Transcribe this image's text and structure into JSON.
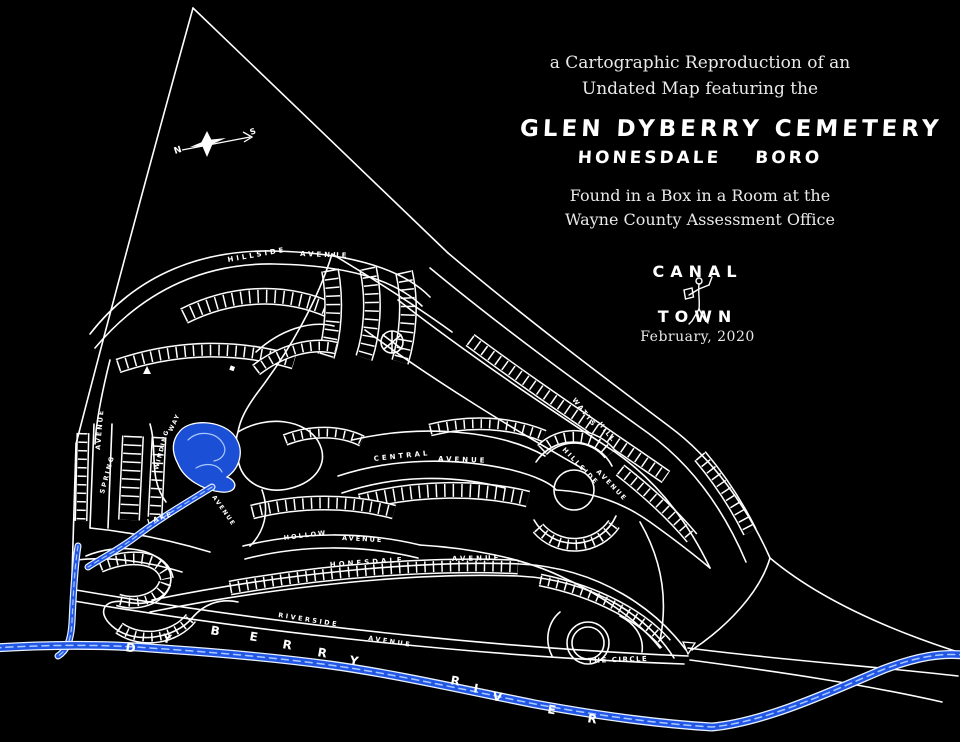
{
  "title_block": {
    "subtitle1": "a Cartographic Reproduction of an",
    "subtitle2": "Undated Map featuring the",
    "heading1": "GLEN DYBERRY CEMETERY",
    "heading2_left": "HONESDALE",
    "heading2_right": "BORO",
    "found1": "Found in a Box in a Room at the",
    "found2": "Wayne County Assessment Office"
  },
  "logo": {
    "top": "CANAL",
    "bottom": "TOWN",
    "date": "February, 2020"
  },
  "map": {
    "compass": {
      "north": "N",
      "south": "S"
    },
    "street_labels": [
      {
        "text": "HILLSIDE",
        "x": 228,
        "y": 262,
        "r": -10,
        "s": 7,
        "ls": 3
      },
      {
        "text": "AVENUE",
        "x": 300,
        "y": 256,
        "r": 2,
        "s": 7,
        "ls": 3
      },
      {
        "text": "WATTS",
        "x": 572,
        "y": 400,
        "r": 52,
        "s": 6.5,
        "ls": 2
      },
      {
        "text": "HILL",
        "x": 598,
        "y": 424,
        "r": 52,
        "s": 6.5,
        "ls": 2
      },
      {
        "text": "HILLSIDE",
        "x": 562,
        "y": 450,
        "r": 46,
        "s": 6.5,
        "ls": 2
      },
      {
        "text": "AVENUE",
        "x": 596,
        "y": 472,
        "r": 46,
        "s": 6.5,
        "ls": 2
      },
      {
        "text": "CENTRAL",
        "x": 374,
        "y": 461,
        "r": -6,
        "s": 7,
        "ls": 3
      },
      {
        "text": "AVENUE",
        "x": 438,
        "y": 461,
        "r": 2,
        "s": 7,
        "ls": 3
      },
      {
        "text": "AVENUE",
        "x": 100,
        "y": 450,
        "r": -85,
        "s": 6.5,
        "ls": 2
      },
      {
        "text": "SPRING",
        "x": 104,
        "y": 494,
        "r": -75,
        "s": 6.5,
        "ls": 2
      },
      {
        "text": "WAY",
        "x": 172,
        "y": 432,
        "r": -65,
        "s": 6,
        "ls": 1.5
      },
      {
        "text": "WINDING",
        "x": 158,
        "y": 470,
        "r": -75,
        "s": 6,
        "ls": 1.5
      },
      {
        "text": "LAKE",
        "x": 148,
        "y": 524,
        "r": -18,
        "s": 6.5,
        "ls": 2
      },
      {
        "text": "AVENUE",
        "x": 212,
        "y": 497,
        "r": 55,
        "s": 6,
        "ls": 1.5
      },
      {
        "text": "HOLLOW",
        "x": 284,
        "y": 540,
        "r": -7,
        "s": 6.5,
        "ls": 2
      },
      {
        "text": "AVENUE",
        "x": 342,
        "y": 540,
        "r": 3,
        "s": 6.5,
        "ls": 2
      },
      {
        "text": "HONESDALE",
        "x": 330,
        "y": 567,
        "r": -4,
        "s": 7,
        "ls": 3
      },
      {
        "text": "AVENUE",
        "x": 452,
        "y": 561,
        "r": -1,
        "s": 7,
        "ls": 3
      },
      {
        "text": "RIVERSIDE",
        "x": 278,
        "y": 617,
        "r": 9,
        "s": 6.5,
        "ls": 2.5
      },
      {
        "text": "AVENUE",
        "x": 368,
        "y": 640,
        "r": 9,
        "s": 6.5,
        "ls": 2.5
      },
      {
        "text": "THE CIRCLE",
        "x": 588,
        "y": 663,
        "r": -2,
        "s": 7,
        "ls": 1.5
      }
    ],
    "river_name_letters": [
      {
        "ch": "D",
        "x": 125,
        "y": 651
      },
      {
        "ch": "Y",
        "x": 162,
        "y": 642
      },
      {
        "ch": "B",
        "x": 210,
        "y": 634
      },
      {
        "ch": "E",
        "x": 249,
        "y": 640
      },
      {
        "ch": "R",
        "x": 282,
        "y": 648
      },
      {
        "ch": "R",
        "x": 317,
        "y": 656
      },
      {
        "ch": "Y",
        "x": 349,
        "y": 664
      },
      {
        "ch": "R",
        "x": 450,
        "y": 684
      },
      {
        "ch": "I",
        "x": 473,
        "y": 692
      },
      {
        "ch": "V",
        "x": 492,
        "y": 700
      },
      {
        "ch": "E",
        "x": 547,
        "y": 713
      },
      {
        "ch": "R",
        "x": 587,
        "y": 722
      }
    ],
    "colors": {
      "background": "#000000",
      "line": "#ffffff",
      "water": "#2257e6",
      "water_highlight": "#a9c9ff"
    }
  }
}
